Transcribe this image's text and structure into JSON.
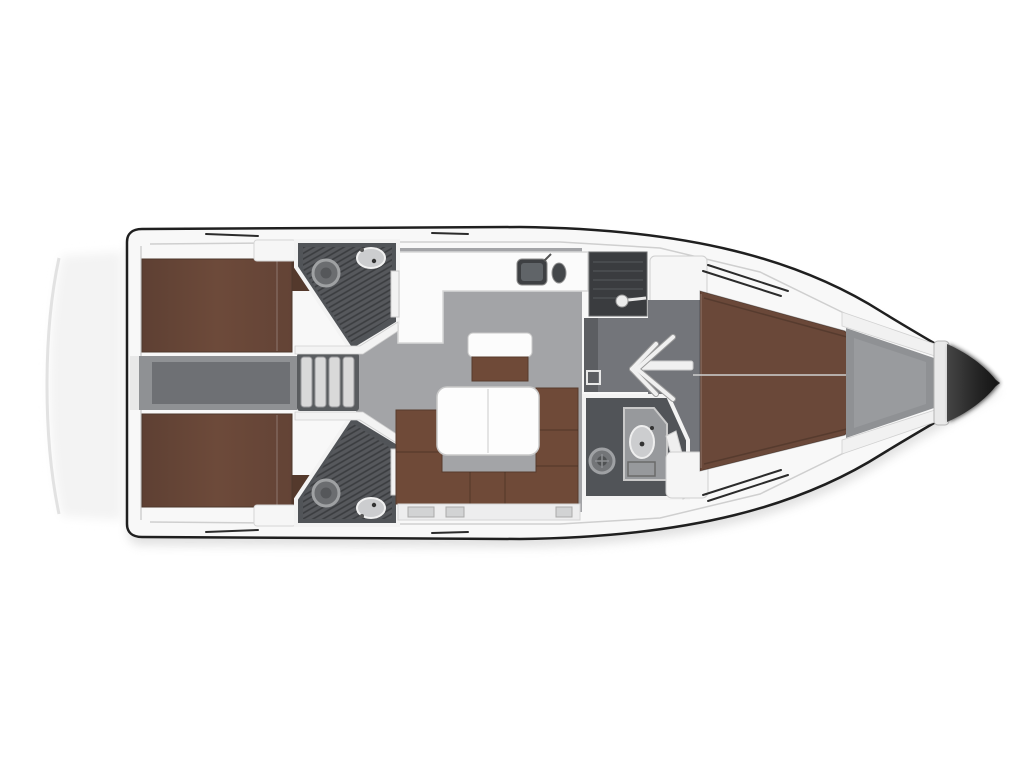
{
  "canvas": {
    "width": 1024,
    "height": 768,
    "background": "#ffffff"
  },
  "plan": {
    "type": "sailboat-interior-floor-plan",
    "orientation": "bow-right-stern-left",
    "regions": [
      "swim-platform",
      "transom",
      "aft-cabin-port",
      "aft-cabin-starboard",
      "engine-compartment",
      "companionway-steps",
      "head-aft-port",
      "head-aft-starboard",
      "galley",
      "nav-station",
      "salon",
      "saloon-table",
      "sofa",
      "side-bench",
      "forward-head",
      "forward-cabin",
      "anchor-locker",
      "bow-tip"
    ]
  },
  "colors": {
    "hull_outline": "#1f1f1f",
    "deck": "#f8f8f8",
    "wall": "#f3f3f3",
    "wall_edge": "#cfcfcf",
    "berth": "#6a4839",
    "berth_dark": "#54392c",
    "sofa": "#6f4a38",
    "floor_salon": "#a3a4a7",
    "floor_corridor": "#73757a",
    "corridor_dark": "#5c5e62",
    "floor_head": "#515458",
    "hatch_base": "#56585c",
    "desk": "#3a3c3f",
    "engine_outer": "#8f9194",
    "engine_inner": "#6e7074",
    "steps_well": "#595c5f",
    "step": "#d9d9d9",
    "locker": "#8f9194",
    "locker_inner": "#999b9e",
    "table": "#fdfdfd",
    "porcelain": "#cccdcf",
    "shadow": "#bcbcbc"
  }
}
